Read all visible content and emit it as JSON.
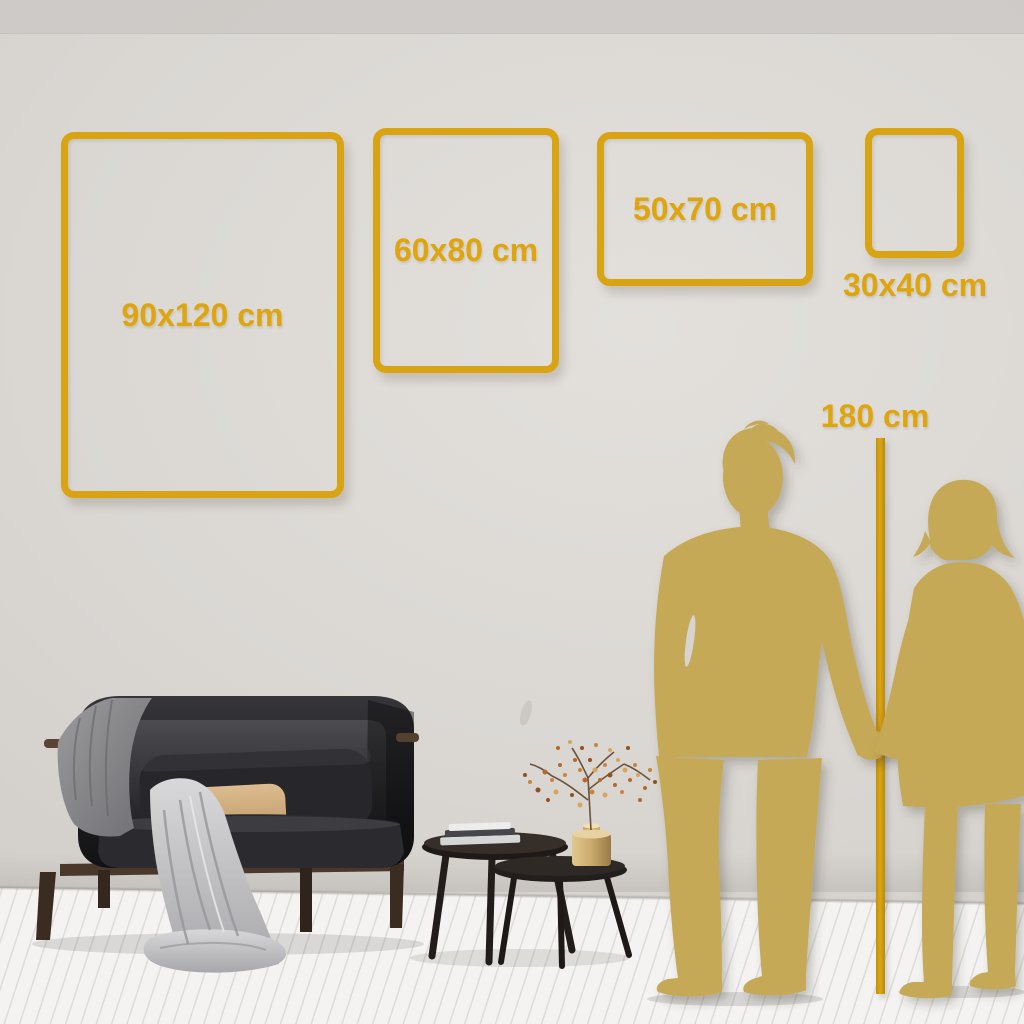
{
  "size_guide": {
    "frames": [
      {
        "label": "90x120 cm",
        "width_cm": 90,
        "height_cm": 120,
        "orientation": "portrait",
        "label_position": "inside"
      },
      {
        "label": "60x80 cm",
        "width_cm": 60,
        "height_cm": 80,
        "orientation": "portrait",
        "label_position": "inside"
      },
      {
        "label": "50x70 cm",
        "width_cm": 50,
        "height_cm": 70,
        "orientation": "landscape",
        "label_position": "inside"
      },
      {
        "label": "30x40 cm",
        "width_cm": 30,
        "height_cm": 40,
        "orientation": "portrait",
        "label_position": "below"
      }
    ],
    "height_marker": {
      "label": "180 cm",
      "height_cm": 180
    }
  },
  "colors": {
    "accent_gold": "#D8A413",
    "label_gold": "#DFA50E",
    "silhouette_gold": "#C6A956",
    "wall": "#D8D5D1",
    "floor": "#F3F2F0"
  },
  "scene": {
    "objects": [
      "sofa",
      "throw-blankets",
      "pillows",
      "nesting-coffee-tables",
      "books",
      "brass-vase",
      "dried-berry-plant",
      "man-silhouette",
      "woman-silhouette"
    ]
  }
}
